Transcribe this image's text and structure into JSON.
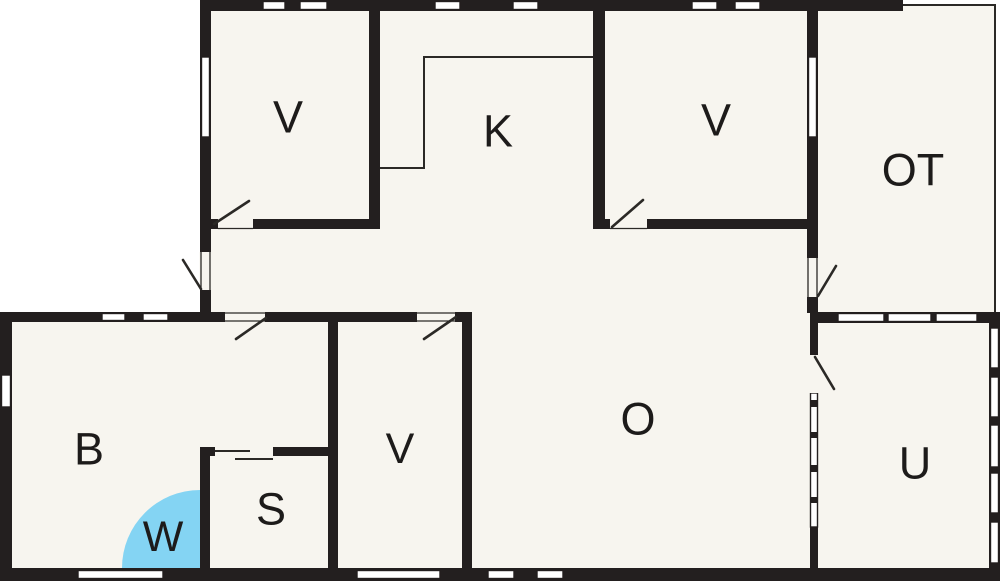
{
  "title": "Floor plan",
  "colors": {
    "wall": "#231f1f",
    "floor": "#f7f5ef",
    "outside": "#ffffff",
    "thin_line": "#2b2926",
    "label": "#1d1b1a",
    "shower_fill": "#84d4f3"
  },
  "rooms": [
    {
      "id": "v1",
      "label": "V"
    },
    {
      "id": "k",
      "label": "K"
    },
    {
      "id": "v2",
      "label": "V"
    },
    {
      "id": "ot",
      "label": "OT"
    },
    {
      "id": "b",
      "label": "B"
    },
    {
      "id": "w",
      "label": "W"
    },
    {
      "id": "s",
      "label": "S"
    },
    {
      "id": "v3",
      "label": "V"
    },
    {
      "id": "o",
      "label": "O"
    },
    {
      "id": "u",
      "label": "U"
    }
  ]
}
